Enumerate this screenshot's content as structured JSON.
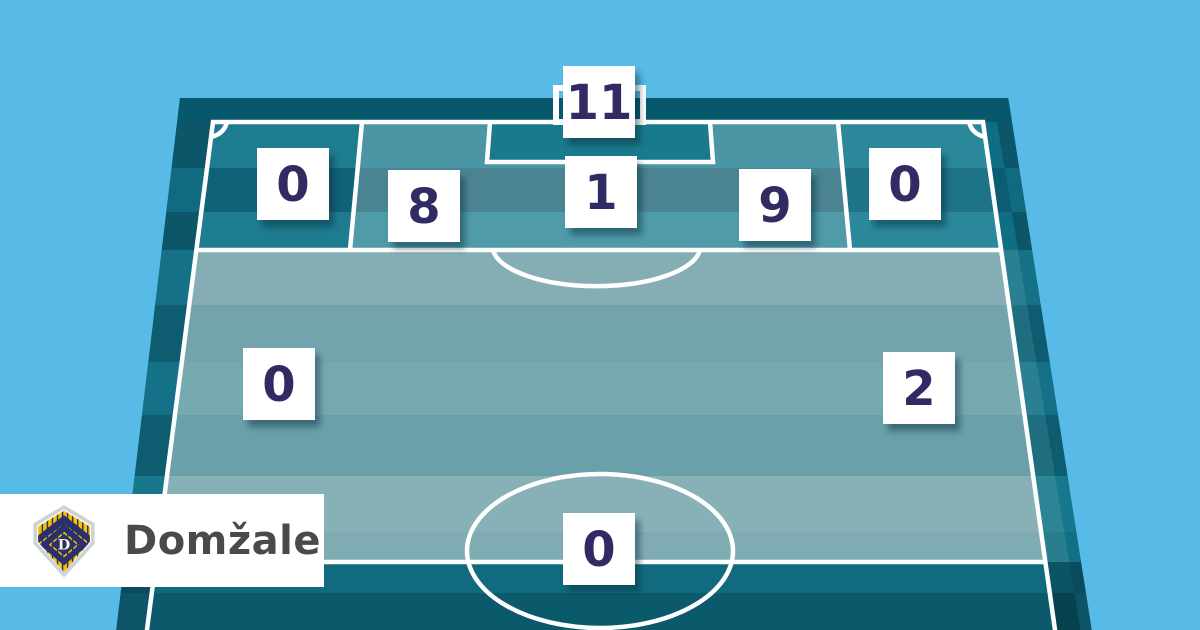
{
  "banner": {
    "team_label": "Domžale"
  },
  "zones": [
    {
      "id": "goal",
      "value": 11
    },
    {
      "id": "six-yard-center",
      "value": 1
    },
    {
      "id": "penalty-left",
      "value": 8
    },
    {
      "id": "penalty-right",
      "value": 9
    },
    {
      "id": "byline-left",
      "value": 0
    },
    {
      "id": "byline-right",
      "value": 0
    },
    {
      "id": "midfield-left",
      "value": 0
    },
    {
      "id": "midfield-right",
      "value": 2
    },
    {
      "id": "center-circle",
      "value": 0
    }
  ],
  "chart_data": {
    "type": "heatmap",
    "title": "",
    "categories": [
      "goal",
      "six-yard-center",
      "penalty-left",
      "penalty-right",
      "byline-left",
      "byline-right",
      "midfield-left",
      "midfield-right",
      "center-circle"
    ],
    "values": [
      11,
      1,
      8,
      9,
      0,
      0,
      0,
      2,
      0
    ],
    "legend_position": "none",
    "notes": "counts per pitch zone, attacking half shown in perspective"
  },
  "colors": {
    "sky": "#58bae7",
    "pitch_wall_dark": "#07586b",
    "pitch_light_stripe": "#85aeb4",
    "pitch_teal_stripe": "#1e7c90",
    "penalty_zone": "#4b96a4",
    "goal_box": "#1a7a8d",
    "line_white": "#ffffff",
    "count_number": "#312b63",
    "team_text": "#4a4a4a",
    "badge_yellow": "#f6c200",
    "badge_navy": "#2a2f6e"
  }
}
